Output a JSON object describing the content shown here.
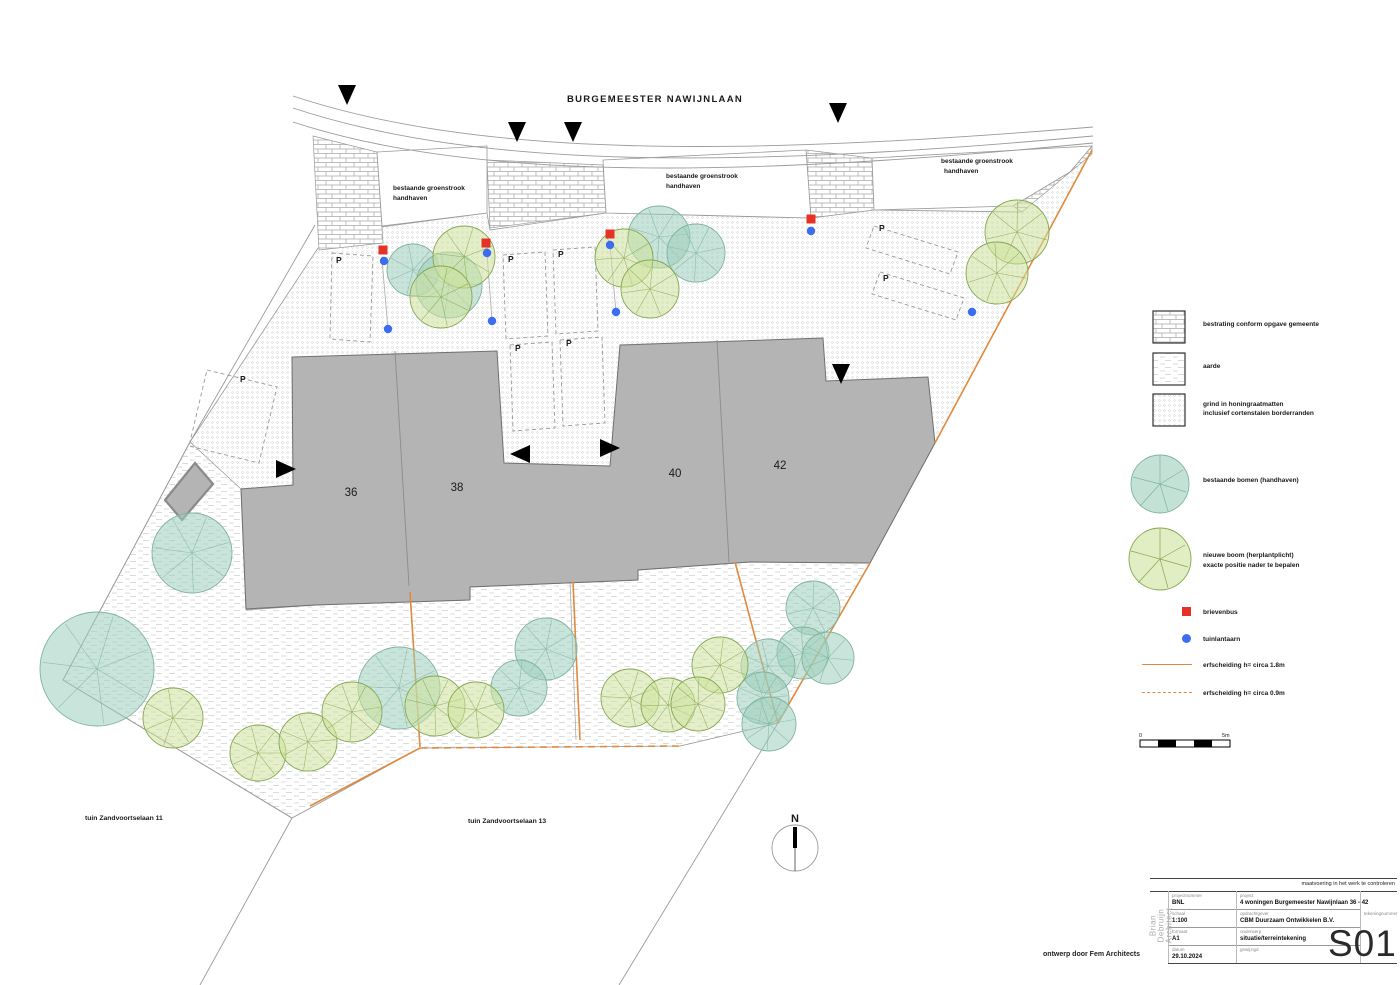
{
  "street": {
    "name": "BURGEMEESTER NAWIJNLAAN"
  },
  "labels": {
    "groenstrook_line1": "bestaande groenstrook",
    "groenstrook_line2": "handhaven",
    "tuin_left": "tuin Zandvoortselaan 11",
    "tuin_right": "tuin Zandvoortselaan 13",
    "credit": "ontwerp door Fem Architects",
    "north": "N",
    "parking": "P"
  },
  "houses": [
    {
      "number": "36"
    },
    {
      "number": "38"
    },
    {
      "number": "40"
    },
    {
      "number": "42"
    }
  ],
  "legend": {
    "items": [
      {
        "label": "bestrating conform opgave gemeente"
      },
      {
        "label": "aarde"
      },
      {
        "label": "grind in honingraatmatten",
        "label2": "inclusief cortenstalen borderranden"
      },
      {
        "label": "bestaande bomen (handhaven)"
      },
      {
        "label": "nieuwe boom (herplantplicht)",
        "label2": "exacte positie nader te bepalen"
      },
      {
        "label": "brievenbus"
      },
      {
        "label": "tuinlantaarn"
      },
      {
        "label": "erfscheiding h= circa 1.8m"
      },
      {
        "label": "erfscheiding h= circa 0.9m"
      }
    ]
  },
  "scalebar": {
    "start": "0",
    "end": "5m"
  },
  "titleblock": {
    "note": "maatvoering in het werk te controleren",
    "architect_lines": [
      "Brian",
      "Debruijn",
      "Architect"
    ],
    "sheet": "S01",
    "fields": {
      "projectnummer": {
        "label": "projectnummer",
        "value": "BNL"
      },
      "project": {
        "label": "project",
        "value": "4 woningen Burgemeester Nawijnlaan 36 - 42"
      },
      "schaal": {
        "label": "schaal",
        "value": "1:100"
      },
      "opdrachtgever": {
        "label": "opdrachtgever",
        "value": "CBM Duurzaam Ontwikkelen B.V."
      },
      "tekeningnummer": {
        "label": "tekeningnummer",
        "value": ""
      },
      "formaat": {
        "label": "formaat",
        "value": "A1"
      },
      "onderwerp": {
        "label": "onderwerp",
        "value": "situatie/terreintekening"
      },
      "datum": {
        "label": "datum",
        "value": "29.10.2024"
      },
      "gewijzigd": {
        "label": "gewijzigd",
        "value": ""
      }
    }
  },
  "plan": {
    "colors": {
      "tree_existing_fill": "#9ccdbb",
      "tree_existing_stroke": "#7fb3a1",
      "tree_new_fill": "#cde29d",
      "tree_new_stroke": "#85a74f",
      "building_fill": "#b4b4b4",
      "building_stroke": "#6f6f6f",
      "boundary_orange": "#e08a3e",
      "mailbox_red": "#e63226",
      "lantern_blue": "#3c6cf0"
    },
    "trees_existing": [
      [
        413,
        270,
        26
      ],
      [
        449,
        285,
        33
      ],
      [
        659,
        237,
        31
      ],
      [
        696,
        253,
        29
      ],
      [
        192,
        553,
        40
      ],
      [
        97,
        669,
        57
      ],
      [
        399,
        688,
        41
      ],
      [
        546,
        649,
        31
      ],
      [
        519,
        688,
        28
      ],
      [
        813,
        608,
        27
      ],
      [
        803,
        653,
        26
      ],
      [
        828,
        658,
        26
      ],
      [
        768,
        666,
        27
      ],
      [
        763,
        698,
        26
      ],
      [
        769,
        724,
        27
      ]
    ],
    "trees_new": [
      [
        464,
        257,
        31
      ],
      [
        441,
        297,
        31
      ],
      [
        624,
        258,
        29
      ],
      [
        650,
        289,
        29
      ],
      [
        1017,
        232,
        32
      ],
      [
        997,
        273,
        31
      ],
      [
        173,
        718,
        30
      ],
      [
        258,
        753,
        28
      ],
      [
        308,
        742,
        29
      ],
      [
        352,
        712,
        30
      ],
      [
        435,
        706,
        30
      ],
      [
        476,
        710,
        28
      ],
      [
        630,
        698,
        29
      ],
      [
        668,
        705,
        27
      ],
      [
        720,
        665,
        28
      ],
      [
        698,
        704,
        27
      ]
    ],
    "mailboxes": [
      [
        383,
        250
      ],
      [
        486,
        243
      ],
      [
        610,
        234
      ],
      [
        811,
        219
      ]
    ],
    "lanterns": [
      [
        384,
        261
      ],
      [
        487,
        253
      ],
      [
        610,
        245
      ],
      [
        811,
        231
      ],
      [
        388,
        329
      ],
      [
        492,
        321
      ],
      [
        616,
        312
      ],
      [
        972,
        312
      ]
    ],
    "parking_positions": [
      [
        240,
        382
      ],
      [
        336,
        263
      ],
      [
        508,
        262
      ],
      [
        558,
        257
      ],
      [
        515,
        351
      ],
      [
        566,
        346
      ],
      [
        879,
        231
      ],
      [
        883,
        281
      ]
    ],
    "arrows": [
      {
        "x": 347,
        "y": 95,
        "dir": "down"
      },
      {
        "x": 517,
        "y": 132,
        "dir": "down"
      },
      {
        "x": 573,
        "y": 132,
        "dir": "down"
      },
      {
        "x": 838,
        "y": 113,
        "dir": "down"
      },
      {
        "x": 841,
        "y": 374,
        "dir": "down"
      },
      {
        "x": 286,
        "y": 469,
        "dir": "right"
      },
      {
        "x": 610,
        "y": 448,
        "dir": "right"
      },
      {
        "x": 520,
        "y": 454,
        "dir": "left"
      }
    ]
  }
}
